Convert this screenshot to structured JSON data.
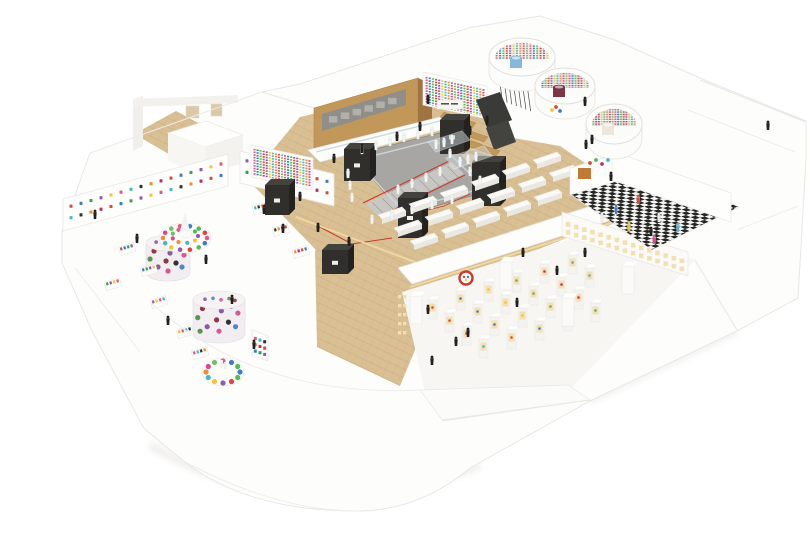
{
  "meta": {
    "type": "photograph",
    "subject": "Architectural scale model of a multi-room retail store interior, aerial isometric view: white foam walls, herringbone wood floors, central escalator atrium with glass balustrade, plywood feature wall with mural band, dark merchandising kiosks, rows of white display tables, three cylindrical display pods with colorful striped interiors, a black-and-white checkerboard room, a gallery of warm-lit display pedestals, rooms lined with colorful graphic T-shirt walls, and tiny black and white human figurines throughout. Small signage on one wall is illegible at this scale.",
    "background": "#ffffff"
  },
  "palette": {
    "background": "#ffffff",
    "model_white": "#fdfdfc",
    "edge_line": "#e8e6e2",
    "shadow": "#eeedeb",
    "wood_floor": "#d9c094",
    "wood_grain": "#c9ac7c",
    "plywood": "#c2985a",
    "plywood_side": "#a07440",
    "mural_bg": "#8f8e88",
    "mural_tile": "#b7b6b0",
    "counter_white": "#fcfcfb",
    "glass": "#ccd7da",
    "void_gray": "#a8a6a2",
    "escalator_gray": "#c9c7c3",
    "step_line": "#9e9c98",
    "red_accent": "#cc3a2a",
    "warm_light": "#f1d9a2",
    "niche_light": "#f5dfae",
    "kiosk_dark": "#302f2b",
    "kiosk_top": "#43423d",
    "kiosk_side": "#232220",
    "checker_dark": "#242421",
    "checker_light": "#f6f6f4",
    "gallery_floor": "#f7f6f3",
    "pedestal_face": "#f4f3f0",
    "mannequin_white": "#f3f5f5",
    "mannequin_stroke": "#d2d8d8",
    "figure_black": "#20201e",
    "door_beige": "#d9c9a8",
    "orange_art": "#c07a36",
    "drum_blue": "#86b7dc",
    "drum_maroon": "#7a3547",
    "drum_cream": "#ece7da"
  },
  "patterns": {
    "stripe_colors": [
      "#e8577f",
      "#3f7fc1",
      "#58b957",
      "#e0453a",
      "#8e5bb5",
      "#f2c53d",
      "#47b8c8",
      "#f08c3a",
      "#d84b8a",
      "#6fc06a"
    ],
    "tshirt_colors": [
      "#d84b3a",
      "#3f7fc1",
      "#2ea84f",
      "#8e5bb5",
      "#f2c53d",
      "#e8577f",
      "#47b8c8",
      "#333333",
      "#f08c3a",
      "#c12f6b"
    ],
    "camo_colors": [
      "#87263a",
      "#222222",
      "#7b4fa0",
      "#3f7fc1",
      "#d84b8a",
      "#4a8f3f"
    ],
    "merch_colors": [
      "#d84b3a",
      "#3f7fc1",
      "#f2c53d",
      "#58b957",
      "#c12f6b",
      "#47b8c8"
    ],
    "checker_figure_colors": [
      "#4a79c4",
      "#d84b3a",
      "#e9e9e7",
      "#58b0d8",
      "#f0c042",
      "#efefed",
      "#d84b8a"
    ]
  },
  "counts": {
    "circular_pods": 3,
    "dark_kiosks": 6,
    "display_tables": 17,
    "gallery_pedestals": 22,
    "gallery_tall_columns": 4,
    "atrium_mannequins": 22,
    "glass_case_mannequins": 6,
    "black_figures": 30,
    "checker_room_figures": 7,
    "cafe_tables": 3,
    "left_room_shelves": 9,
    "camo_cylinders": 2,
    "rainbow_displays": 2
  }
}
